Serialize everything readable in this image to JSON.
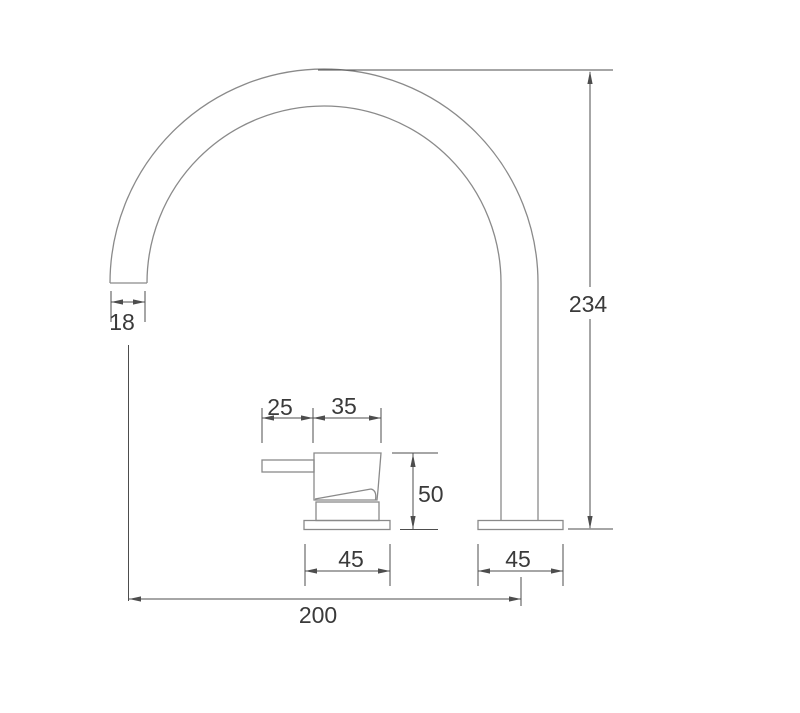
{
  "drawing": {
    "name": "basin-tap-dimension-drawing",
    "type": "technical-drawing",
    "dimensions": {
      "spout_tip_width": "18",
      "overall_height": "234",
      "lever_length": "25",
      "handle_body_width": "35",
      "handle_height": "50",
      "handle_base_width": "45",
      "spout_base_width": "45",
      "spout_reach": "200"
    },
    "colors": {
      "outline": "#8a8a8a",
      "dimension_line": "#4d4d4d",
      "label_text": "#3a3a3a",
      "background": "#ffffff"
    }
  }
}
